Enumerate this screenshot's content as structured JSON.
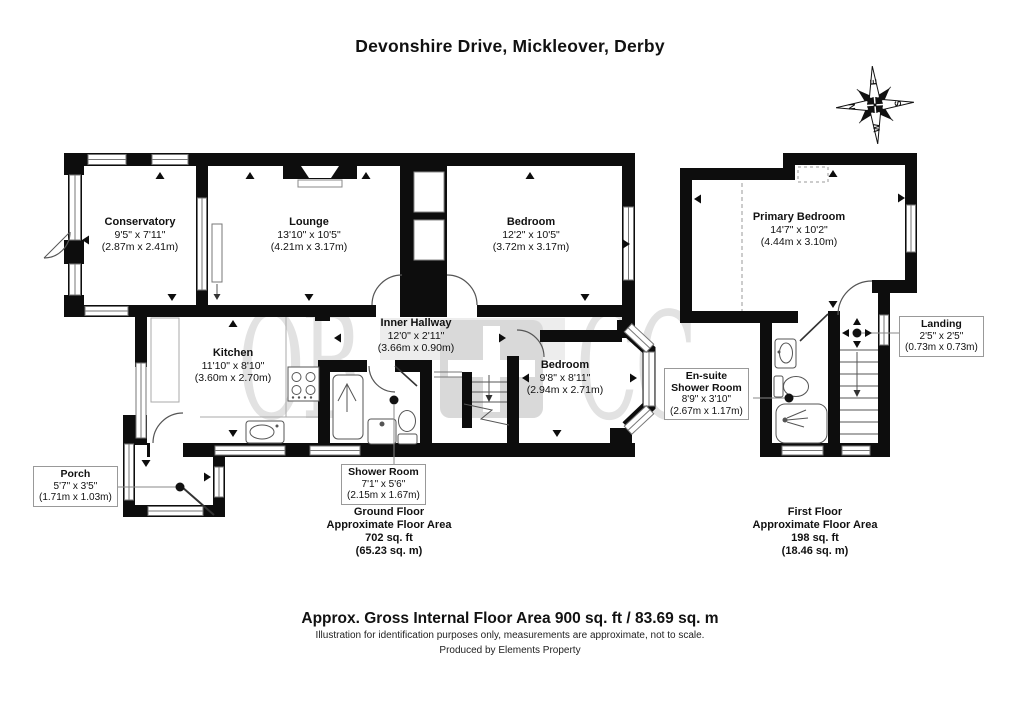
{
  "title": "Devonshire Drive, Mickleover, Derby",
  "compass": {
    "n": "N",
    "e": "E",
    "s": "S",
    "w": "W"
  },
  "watermark": {
    "left": "OB",
    "right": "CC"
  },
  "ground_floor": {
    "rooms": {
      "conservatory": {
        "name": "Conservatory",
        "imperial": "9'5\" x 7'11\"",
        "metric": "(2.87m x 2.41m)"
      },
      "lounge": {
        "name": "Lounge",
        "imperial": "13'10\" x 10'5\"",
        "metric": "(4.21m x 3.17m)"
      },
      "bedroom_front": {
        "name": "Bedroom",
        "imperial": "12'2\" x 10'5\"",
        "metric": "(3.72m x 3.17m)"
      },
      "inner_hallway": {
        "name": "Inner Hallway",
        "imperial": "12'0\" x 2'11\"",
        "metric": "(3.66m x 0.90m)"
      },
      "kitchen": {
        "name": "Kitchen",
        "imperial": "11'10\" x 8'10\"",
        "metric": "(3.60m x 2.70m)"
      },
      "bedroom_rear": {
        "name": "Bedroom",
        "imperial": "9'8\" x 8'11\"",
        "metric": "(2.94m x 2.71m)"
      }
    },
    "callouts": {
      "porch": {
        "name": "Porch",
        "imperial": "5'7\" x 3'5\"",
        "metric": "(1.71m x 1.03m)"
      },
      "shower_room": {
        "name": "Shower Room",
        "imperial": "7'1\" x 5'6\"",
        "metric": "(2.15m x 1.67m)"
      }
    },
    "area": {
      "floor": "Ground Floor",
      "label": "Approximate Floor Area",
      "sqft": "702 sq. ft",
      "sqm": "(65.23 sq. m)"
    }
  },
  "first_floor": {
    "rooms": {
      "primary_bedroom": {
        "name": "Primary Bedroom",
        "imperial": "14'7\" x 10'2\"",
        "metric": "(4.44m x 3.10m)"
      }
    },
    "callouts": {
      "landing": {
        "name": "Landing",
        "imperial": "2'5\" x 2'5\"",
        "metric": "(0.73m x 0.73m)"
      },
      "ensuite": {
        "name_line1": "En-suite",
        "name_line2": "Shower Room",
        "imperial": "8'9\" x 3'10\"",
        "metric": "(2.67m x 1.17m)"
      }
    },
    "area": {
      "floor": "First Floor",
      "label": "Approximate Floor Area",
      "sqft": "198 sq. ft",
      "sqm": "(18.46 sq. m)"
    }
  },
  "footer": {
    "area_summary": "Approx. Gross Internal Floor Area 900 sq. ft / 83.69 sq. m",
    "disclaimer": "Illustration for identification purposes only, measurements are approximate, not to scale.",
    "credit": "Produced by Elements Property"
  }
}
